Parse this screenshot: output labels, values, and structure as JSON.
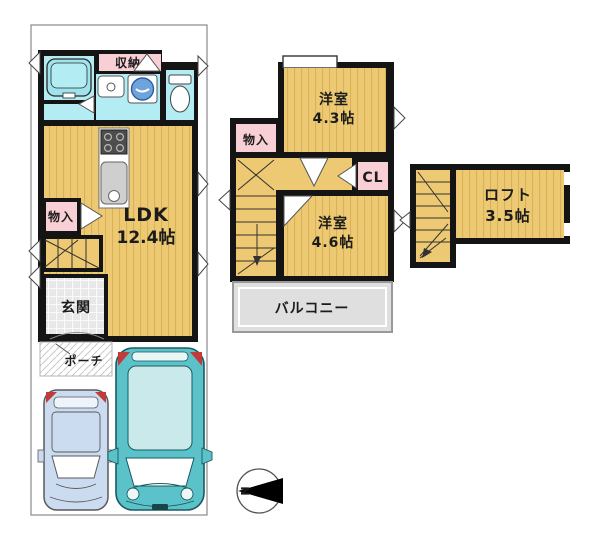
{
  "plan_title": "house-floor-plan",
  "floor1": {
    "storage_top_label": "収納",
    "closet_label": "物入",
    "ldk_label": "LDK",
    "ldk_size": "12.4帖",
    "entrance_label": "玄関",
    "porch_label": "ポーチ"
  },
  "floor2": {
    "closet_label": "物入",
    "room_a_label": "洋室",
    "room_a_size": "4.3帖",
    "cl_label": "CL",
    "room_b_label": "洋室",
    "room_b_size": "4.6帖",
    "balcony_label": "バルコニー"
  },
  "loft": {
    "label": "ロフト",
    "size": "3.5帖"
  },
  "compass": {
    "north_label": "N"
  },
  "colors": {
    "floor_tan": "#ecc972",
    "floor_stripe": "#d9b257",
    "closet_pink": "#f9cfd6",
    "wet_area_cyan": "#b3ecf2",
    "wall_black": "#141414",
    "balcony_gray": "#dfdfdf",
    "car_teal": "#5cc2ca",
    "car_light_blue": "#cbdcf0",
    "marker_red": "#c23b3b",
    "washer_blue": "#6fa3dc"
  }
}
